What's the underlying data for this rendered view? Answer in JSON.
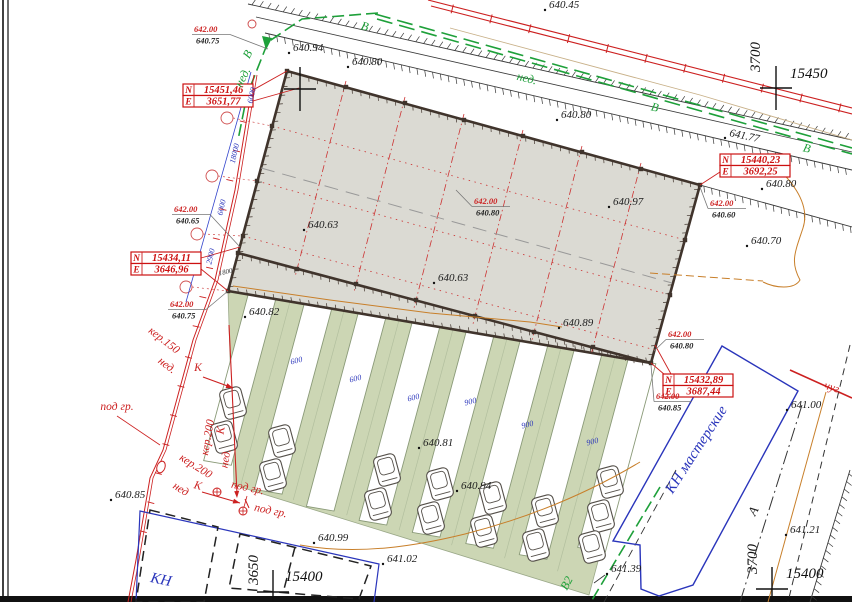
{
  "drawing": {
    "type": "Топографический план участка",
    "colors": {
      "building_fill": "#dbdad3",
      "building_wall": "#40342c",
      "parking_fill": "#ccd6b4",
      "grid_red": "#cc3333",
      "utility_red": "#cc2020",
      "water_green": "#1ea03a",
      "contour_orange": "#c87f2a",
      "boundary_blue": "#2a35bb"
    }
  },
  "coordinate_boxes": [
    {
      "rows": [
        {
          "k": "N",
          "v": "15451,46"
        },
        {
          "k": "E",
          "v": "3651,77"
        }
      ]
    },
    {
      "rows": [
        {
          "k": "N",
          "v": "15440,23"
        },
        {
          "k": "E",
          "v": "3692,25"
        }
      ]
    },
    {
      "rows": [
        {
          "k": "N",
          "v": "15434,11"
        },
        {
          "k": "E",
          "v": "3646,96"
        }
      ]
    },
    {
      "rows": [
        {
          "k": "N",
          "v": "15432,89"
        },
        {
          "k": "E",
          "v": "3687,44"
        }
      ]
    }
  ],
  "grid_crosses": [
    [
      300,
      89
    ],
    [
      776,
      88
    ],
    [
      273,
      592
    ],
    [
      772,
      589
    ]
  ],
  "level_pairs": [
    {
      "r": "642.00",
      "b": "640.75",
      "x": 194,
      "y": 32,
      "ax": 268,
      "ay": 49
    },
    {
      "r": "642.00",
      "b": "640.65",
      "x": 174,
      "y": 212,
      "ax": 240,
      "ay": 247
    },
    {
      "r": "642.00",
      "b": "640.75",
      "x": 170,
      "y": 307,
      "ax": 228,
      "ay": 291
    },
    {
      "r": "642.00",
      "b": "640.80",
      "x": 474,
      "y": 204,
      "ax": 456,
      "ay": 190
    },
    {
      "r": "642.00",
      "b": "640.60",
      "x": 710,
      "y": 206,
      "ax": 700,
      "ay": 187
    },
    {
      "r": "642.00",
      "b": "640.80",
      "x": 668,
      "y": 337,
      "ax": 654,
      "ay": 351
    },
    {
      "r": "642.00",
      "b": "640.85",
      "x": 656,
      "y": 399,
      "ax": 651,
      "ay": 365
    }
  ],
  "labels": [
    {
      "t": "640.45",
      "x": 549,
      "y": 8,
      "c": "spot",
      "a": "s"
    },
    {
      "t": "640.94",
      "x": 293,
      "y": 51,
      "c": "spot",
      "a": "s"
    },
    {
      "t": "640.80",
      "x": 352,
      "y": 65,
      "c": "spot",
      "a": "s"
    },
    {
      "t": "640.80",
      "x": 561,
      "y": 118,
      "c": "spot",
      "a": "s"
    },
    {
      "t": "641.77",
      "x": 729,
      "y": 136,
      "r": 12,
      "c": "spot",
      "a": "s"
    },
    {
      "t": "640.80",
      "x": 766,
      "y": 187,
      "c": "spot",
      "a": "s"
    },
    {
      "t": "640.70",
      "x": 751,
      "y": 244,
      "c": "spot",
      "a": "s"
    },
    {
      "t": "640.63",
      "x": 308,
      "y": 228,
      "c": "spot",
      "a": "s"
    },
    {
      "t": "640.97",
      "x": 613,
      "y": 205,
      "c": "spot",
      "a": "s"
    },
    {
      "t": "640.63",
      "x": 438,
      "y": 281,
      "c": "spot",
      "a": "s"
    },
    {
      "t": "640.89",
      "x": 563,
      "y": 326,
      "c": "spot",
      "a": "s"
    },
    {
      "t": "640.82",
      "x": 249,
      "y": 315,
      "c": "spot",
      "a": "s"
    },
    {
      "t": "640.81",
      "x": 423,
      "y": 446,
      "c": "spot",
      "a": "s"
    },
    {
      "t": "640.94",
      "x": 461,
      "y": 489,
      "c": "spot",
      "a": "s"
    },
    {
      "t": "640.85",
      "x": 115,
      "y": 498,
      "c": "spot",
      "a": "s"
    },
    {
      "t": "640.99",
      "x": 318,
      "y": 541,
      "c": "spot",
      "a": "s"
    },
    {
      "t": "641.02",
      "x": 387,
      "y": 562,
      "c": "spot",
      "a": "s"
    },
    {
      "t": "641.39",
      "x": 611,
      "y": 572,
      "c": "spot",
      "a": "s"
    },
    {
      "t": "641.00",
      "x": 791,
      "y": 408,
      "c": "spot",
      "a": "s"
    },
    {
      "t": "641.21",
      "x": 790,
      "y": 533,
      "c": "spot",
      "a": "s"
    },
    {
      "t": "3700",
      "x": 760,
      "y": 57,
      "r": -90,
      "c": "bigcoord"
    },
    {
      "t": "15450",
      "x": 790,
      "y": 78,
      "c": "bigcoord",
      "a": "s"
    },
    {
      "t": "3650",
      "x": 258,
      "y": 570,
      "r": -90,
      "c": "bigcoord"
    },
    {
      "t": "15400",
      "x": 285,
      "y": 581,
      "c": "bigcoord",
      "a": "s"
    },
    {
      "t": "3700",
      "x": 757,
      "y": 559,
      "r": -90,
      "c": "bigcoord"
    },
    {
      "t": "15400",
      "x": 786,
      "y": 578,
      "c": "bigcoord",
      "a": "s"
    },
    {
      "t": "В",
      "x": 364,
      "y": 30,
      "r": 14,
      "c": "green-lbl"
    },
    {
      "t": "нед.",
      "x": 526,
      "y": 82,
      "r": 14,
      "c": "green-lbl"
    },
    {
      "t": "В",
      "x": 654,
      "y": 111,
      "r": 14,
      "c": "green-lbl"
    },
    {
      "t": "В",
      "x": 806,
      "y": 152,
      "r": 14,
      "c": "green-lbl"
    },
    {
      "t": "В",
      "x": 251,
      "y": 56,
      "r": -62,
      "c": "green-lbl"
    },
    {
      "t": "нед.",
      "x": 246,
      "y": 79,
      "r": -62,
      "c": "green-lbl"
    },
    {
      "t": "В2",
      "x": 570,
      "y": 585,
      "r": -62,
      "c": "green-lbl"
    },
    {
      "t": "кер.150",
      "x": 162,
      "y": 343,
      "r": 38,
      "c": "red-lbl"
    },
    {
      "t": "нед.",
      "x": 165,
      "y": 368,
      "r": 38,
      "c": "red-lbl"
    },
    {
      "t": "К",
      "x": 198,
      "y": 371,
      "c": "red-lbl"
    },
    {
      "t": "кер.200",
      "x": 211,
      "y": 438,
      "r": -80,
      "c": "red-lbl"
    },
    {
      "t": "К",
      "x": 224,
      "y": 431,
      "r": -80,
      "c": "red-lbl"
    },
    {
      "t": "нед.",
      "x": 229,
      "y": 459,
      "r": -80,
      "c": "red-lbl"
    },
    {
      "t": "кер.200",
      "x": 194,
      "y": 469,
      "r": 32,
      "c": "red-lbl"
    },
    {
      "t": "К",
      "x": 197,
      "y": 489,
      "r": 15,
      "c": "red-lbl"
    },
    {
      "t": "нед",
      "x": 179,
      "y": 492,
      "r": 32,
      "c": "red-lbl"
    },
    {
      "t": "под гр.",
      "x": 117,
      "y": 410,
      "c": "red-lbl"
    },
    {
      "t": "под гр.",
      "x": 247,
      "y": 491,
      "r": 12,
      "c": "red-lbl"
    },
    {
      "t": "под гр.",
      "x": 270,
      "y": 514,
      "r": 12,
      "c": "red-lbl"
    },
    {
      "t": "чуг.",
      "x": 832,
      "y": 391,
      "r": 18,
      "c": "red-lbl"
    },
    {
      "t": "6000",
      "x": 254,
      "y": 96,
      "r": -77,
      "c": "blue-dim"
    },
    {
      "t": "18000",
      "x": 237,
      "y": 154,
      "r": -77,
      "c": "blue-dim"
    },
    {
      "t": "6000",
      "x": 224,
      "y": 208,
      "r": -77,
      "c": "blue-dim"
    },
    {
      "t": "2900",
      "x": 213,
      "y": 257,
      "r": -77,
      "c": "blue-dim"
    },
    {
      "t": "1800",
      "x": 226,
      "y": 274,
      "r": -12,
      "c": "blk-dim"
    },
    {
      "t": "600",
      "x": 297,
      "y": 363,
      "r": -14,
      "c": "blue-dim"
    },
    {
      "t": "600",
      "x": 356,
      "y": 381,
      "r": -14,
      "c": "blue-dim"
    },
    {
      "t": "600",
      "x": 414,
      "y": 400,
      "r": -14,
      "c": "blue-dim"
    },
    {
      "t": "900",
      "x": 471,
      "y": 404,
      "r": -14,
      "c": "blue-dim"
    },
    {
      "t": "900",
      "x": 528,
      "y": 427,
      "r": -14,
      "c": "blue-dim"
    },
    {
      "t": "900",
      "x": 593,
      "y": 444,
      "r": -14,
      "c": "blue-dim"
    },
    {
      "t": "КН",
      "x": 160,
      "y": 584,
      "r": 12,
      "c": "blue-name"
    },
    {
      "t": "КН мастерские",
      "x": 700,
      "y": 452,
      "r": -57,
      "c": "blue-name"
    },
    {
      "t": "А",
      "x": 757,
      "y": 513,
      "r": -62,
      "c": "axis-a"
    }
  ]
}
